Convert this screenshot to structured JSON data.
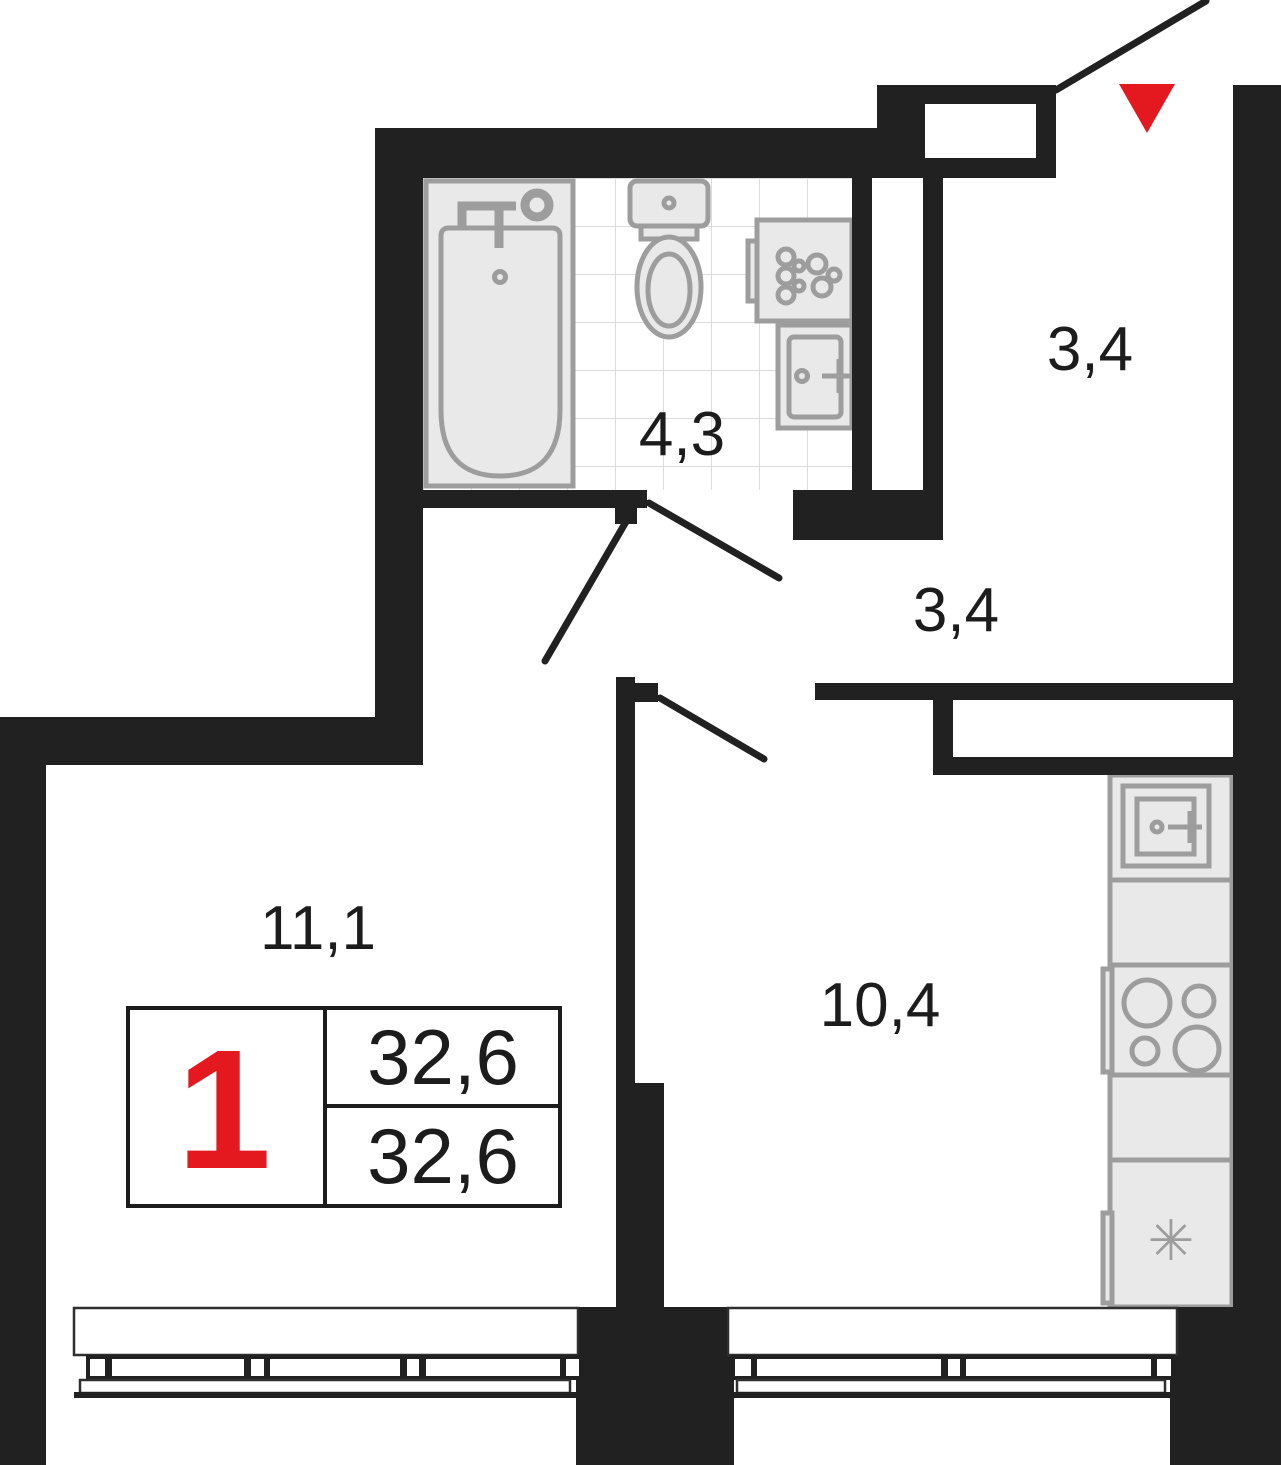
{
  "plan": {
    "legend": {
      "rooms_count": "1",
      "area_top": "32,6",
      "area_bottom": "32,6"
    },
    "labels": {
      "bathroom": "4,3",
      "entry_hall": "3,4",
      "hallway": "3,4",
      "living_room": "11,1",
      "kitchen": "10,4"
    },
    "icons": {
      "fridge_symbol": "✳"
    },
    "colors": {
      "wall": "#212121",
      "red": "#e41920",
      "ink": "#1c1c1c",
      "fixture_fill": "#e9e9e9",
      "fixture_stroke": "#9d9d9d",
      "tile_line": "#dcdcdc",
      "sill": "#2f2f2f"
    }
  }
}
